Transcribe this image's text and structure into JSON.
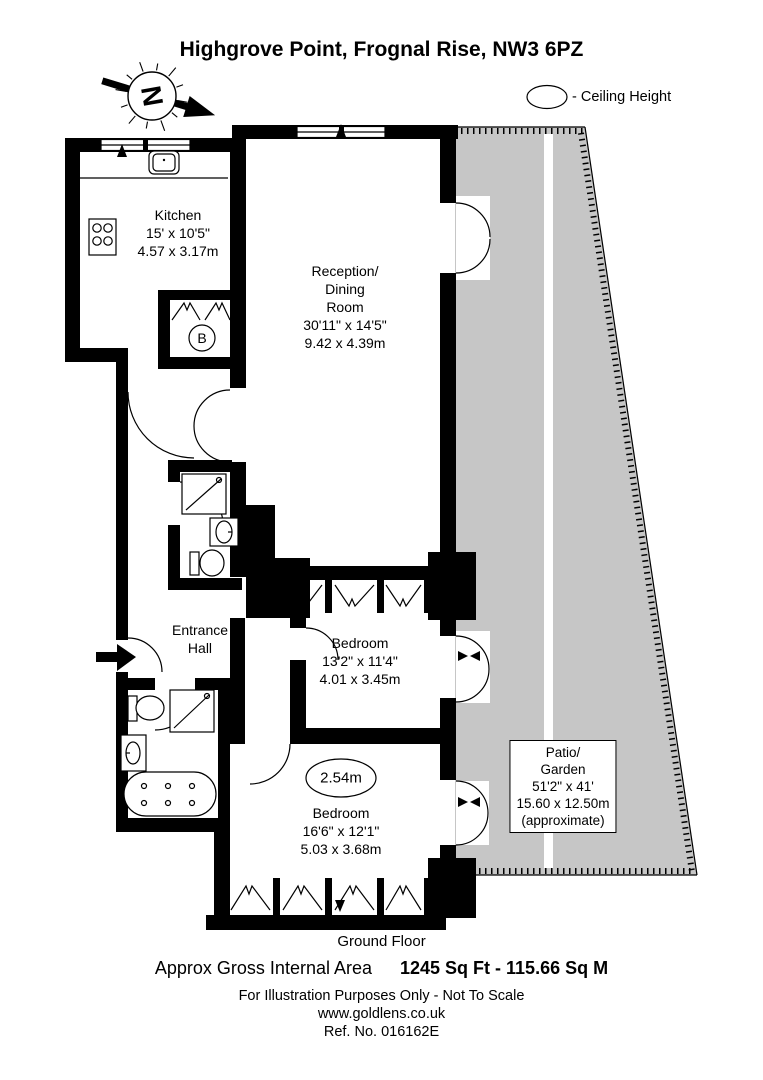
{
  "title": {
    "line1": "Highgrove Point,",
    "line2": "Frognal Rise, NW3 6PZ"
  },
  "compass": {
    "letter": "N"
  },
  "legend": {
    "ceiling_height_label": "- Ceiling Height"
  },
  "rooms": {
    "kitchen": {
      "name": "Kitchen",
      "imperial": "15' x 10'5\"",
      "metric": "4.57 x 3.17m"
    },
    "reception": {
      "name_line1": "Reception/",
      "name_line2": "Dining",
      "name_line3": "Room",
      "imperial": "30'11\" x 14'5\"",
      "metric": "9.42 x 4.39m"
    },
    "entrance_hall": {
      "name_line1": "Entrance",
      "name_line2": "Hall"
    },
    "bedroom1": {
      "name": "Bedroom",
      "imperial": "13'2\" x 11'4\"",
      "metric": "4.01 x 3.45m"
    },
    "bedroom2": {
      "name": "Bedroom",
      "imperial": "16'6\" x 12'1\"",
      "metric": "5.03 x 3.68m",
      "ceiling_height": "2.54m"
    },
    "patio": {
      "name_line1": "Patio/",
      "name_line2": "Garden",
      "imperial": "51'2\" x 41'",
      "metric": "15.60 x 12.50m",
      "note": "(approximate)"
    },
    "boiler": {
      "label": "B"
    }
  },
  "footer": {
    "floor": "Ground Floor",
    "area_label": "Approx Gross Internal Area",
    "area_value": "1245 Sq Ft  -  115.66 Sq M",
    "disclaimer": "For Illustration Purposes Only - Not To Scale",
    "website": "www.goldlens.co.uk",
    "reference": "Ref. No. 016162E"
  },
  "colors": {
    "patio_fill": "#c6c6c6",
    "wall": "#000000",
    "background": "#ffffff"
  }
}
